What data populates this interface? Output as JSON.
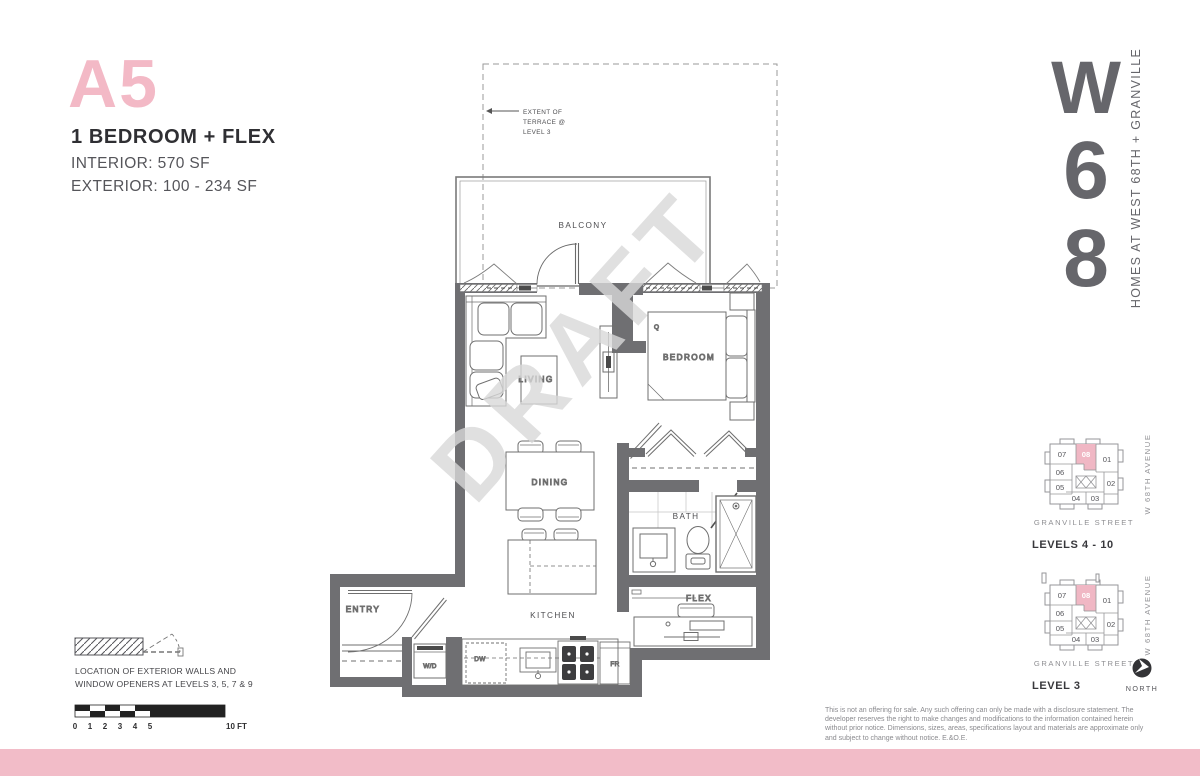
{
  "header": {
    "unit_code": "A5",
    "unit_type": "1 BEDROOM + FLEX",
    "interior": "INTERIOR:  570 SF",
    "exterior": "EXTERIOR: 100 - 234 SF"
  },
  "logo": {
    "letter_w": "W",
    "letter_6": "6",
    "letter_8": "8",
    "tagline": "HOMES AT WEST 68TH + GRANVILLE"
  },
  "plan": {
    "watermark": "DRAFT",
    "terrace_note_1": "EXTENT OF",
    "terrace_note_2": "TERRACE @",
    "terrace_note_3": "LEVEL 3",
    "rooms": {
      "balcony": "BALCONY",
      "living": "LIVING",
      "bedroom": "BEDROOM",
      "dining": "DINING",
      "bath": "BATH",
      "kitchen": "KITCHEN",
      "flex": "FLEX",
      "entry": "ENTRY"
    },
    "tags": {
      "wd": "W/D",
      "dw": "DW",
      "fr": "FR",
      "q": "Q"
    }
  },
  "keyplans": {
    "units": [
      {
        "label": "07"
      },
      {
        "label": "08"
      },
      {
        "label": "01"
      },
      {
        "label": "06"
      },
      {
        "label": "05"
      },
      {
        "label": "04"
      },
      {
        "label": "03"
      },
      {
        "label": "02"
      }
    ],
    "granville": "GRANVILLE STREET",
    "avenue": "W 68TH AVENUE",
    "kp1_level": "LEVELS 4 - 10",
    "kp2_level": "LEVEL 3",
    "north": "NORTH"
  },
  "legend": {
    "line1": "LOCATION OF EXTERIOR WALLS AND",
    "line2": "WINDOW OPENERS AT LEVELS 3, 5, 7 & 9",
    "scale_numbers": [
      "0",
      "1",
      "2",
      "3",
      "4",
      "5"
    ],
    "scale_end": "10 FT"
  },
  "disclaimer": "This is not an offering for sale. Any such offering can only be made with a disclosure statement. The developer reserves the right to make changes and modifications to the information contained herein without prior notice. Dimensions, sizes, areas, specifications layout and materials are approximate only and subject to change without notice. E.&O.E.",
  "colors": {
    "pink": "#f2bcc8",
    "pink_text": "#f3b9c6",
    "wall_gray": "#6f6f72",
    "logo_gray": "#66666b",
    "watermark_gray": "#d9d9d9"
  }
}
